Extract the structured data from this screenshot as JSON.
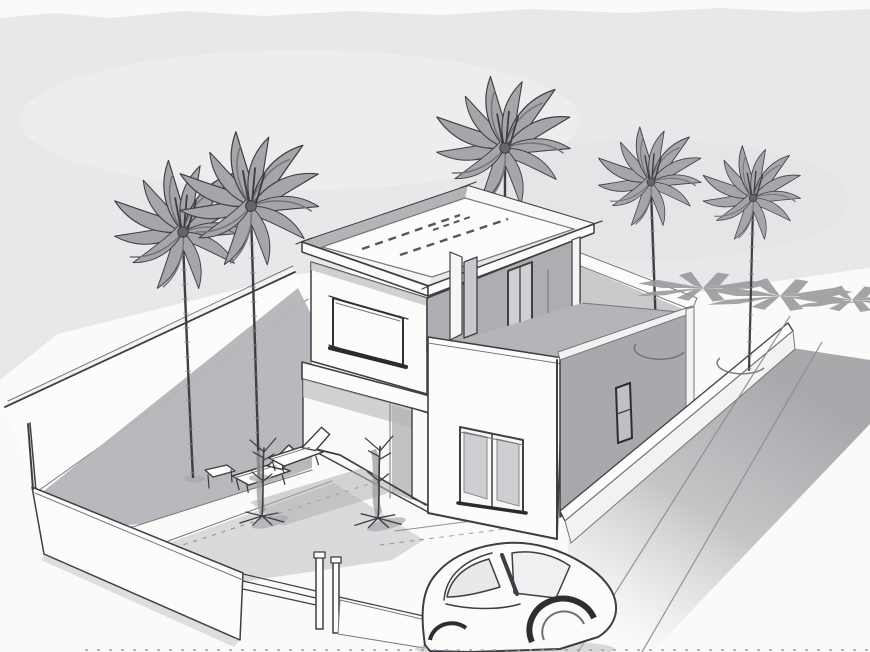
{
  "scene": {
    "title": "Architectural concept sketch: modern two-storey flat-roof villa with walled courtyard, five palm trees and a parked car",
    "medium": "grayscale hand-drawn style perspective sketch on paper",
    "view": "aerial three-quarter perspective from the south-west",
    "elements": {
      "house": "two-storey white modern villa with roof parapet, corner glazing, sliding door and roof terrace over a one-storey wing",
      "courtyard": "walled front yard with paved paths, two lounge chairs, side table and two potted plants",
      "palm_trees": 5,
      "street": "shaded street along the right boundary wall with curb lines and palm shadows",
      "car": "sketched hatchback parked at the driveway corner",
      "gate": "front boundary wall with twin gate posts and rails"
    }
  },
  "palette": {
    "paper": "#fafaf9",
    "sky": "#e8e8ea",
    "ink": "#3f3f43",
    "ink-soft": "#77777b",
    "wall": "#fcfcfb",
    "gray-light": "#d2d2d5",
    "gray-mid": "#b5b5b9",
    "gray-dark": "#a9a9ad",
    "gray-deep": "#98989c",
    "glass": "#c9c9cd",
    "frond": "#a6a6aa",
    "shade": "#9b9b9f"
  }
}
